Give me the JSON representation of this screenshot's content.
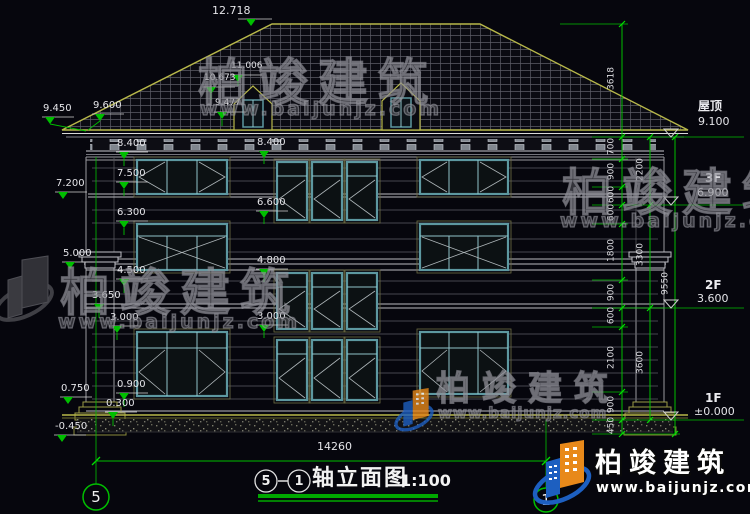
{
  "colors": {
    "background": "#06060d",
    "dim_green": "#00bf00",
    "label_white": "#e4e4e8",
    "outline_olive": "#b8b84a",
    "window_teal": "#5d98a0",
    "logo_blue": "#1d5fc0",
    "logo_orange": "#e8891a",
    "watermark_grey": "#7d7d82"
  },
  "brand": {
    "name": "柏竣建筑",
    "url": "www.baijunjz.com"
  },
  "title": {
    "axis_from": "5",
    "axis_to": "1",
    "name": "轴立面图",
    "scale": "1:100"
  },
  "axes": {
    "left": "5",
    "right": "1"
  },
  "bottom_dim": "14260",
  "levels": [
    {
      "name": "屋顶",
      "elev": "9.100"
    },
    {
      "name": "3F",
      "elev": "6.900"
    },
    {
      "name": "2F",
      "elev": "3.600"
    },
    {
      "name": "1F",
      "elev": "±0.000"
    }
  ],
  "marks": {
    "roof": [
      "12.718",
      "11.006",
      "10.673",
      "9.477"
    ],
    "left_outer": [
      "9.450",
      "9.600",
      "7.200",
      "5.000",
      "0.750",
      "-0.450"
    ],
    "left_inner": [
      "8.400",
      "7.500",
      "6.300",
      "4.500",
      "3.650",
      "3.000",
      "0.900",
      "0.300"
    ],
    "center": [
      "8.400",
      "6.600",
      "4.800",
      "3.000"
    ]
  },
  "right_chain": {
    "segments": [
      "3618",
      "700",
      "900",
      "600",
      "600",
      "1800",
      "900",
      "600",
      "2100",
      "900",
      "450"
    ],
    "subtotals": [
      "2200",
      "3300",
      "3600"
    ],
    "overall": "9550"
  }
}
